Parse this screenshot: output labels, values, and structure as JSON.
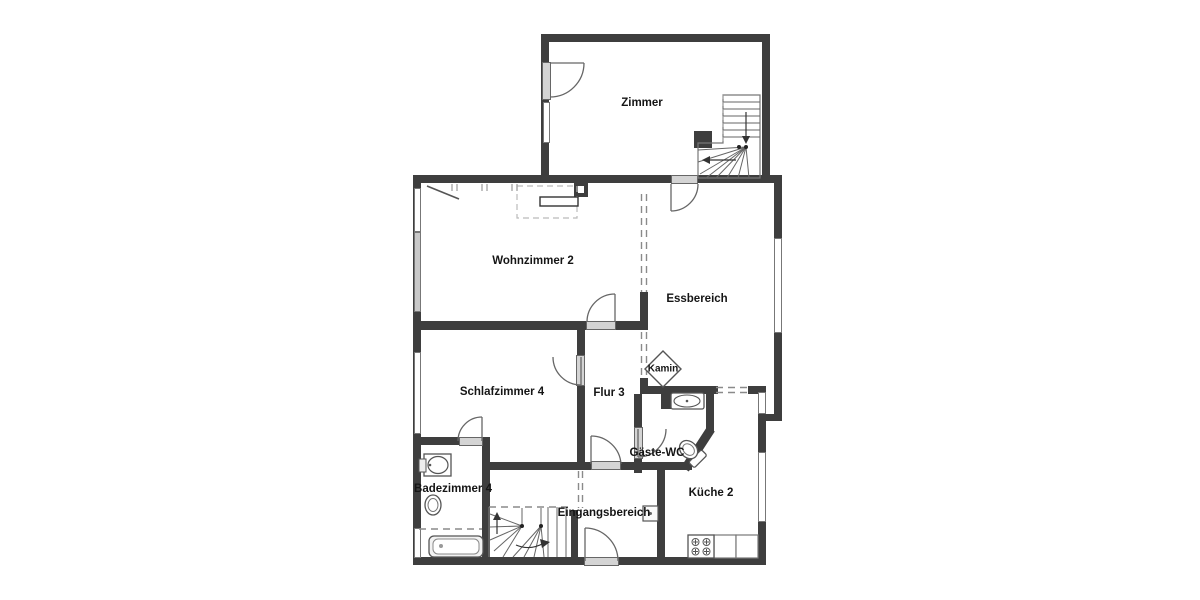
{
  "rooms": {
    "zimmer": {
      "label": "Zimmer"
    },
    "wohnzimmer": {
      "label": "Wohnzimmer 2"
    },
    "essbereich": {
      "label": "Essbereich"
    },
    "kamin": {
      "label": "Kamin"
    },
    "schlafzimmer": {
      "label": "Schlafzimmer 4"
    },
    "flur": {
      "label": "Flur 3"
    },
    "badezimmer": {
      "label": "Badezimmer 4"
    },
    "gaeste_wc": {
      "label": "Gäste-WC"
    },
    "eingangsbereich": {
      "label": "Eingangsbereich"
    },
    "kueche": {
      "label": "Küche 2"
    }
  },
  "colors": {
    "wall": "#3e3e3e",
    "window_gray": "#c9c9c9",
    "door_sill": "#d4d4d4",
    "line": "#666666",
    "text": "#151515",
    "background": "#ffffff"
  }
}
